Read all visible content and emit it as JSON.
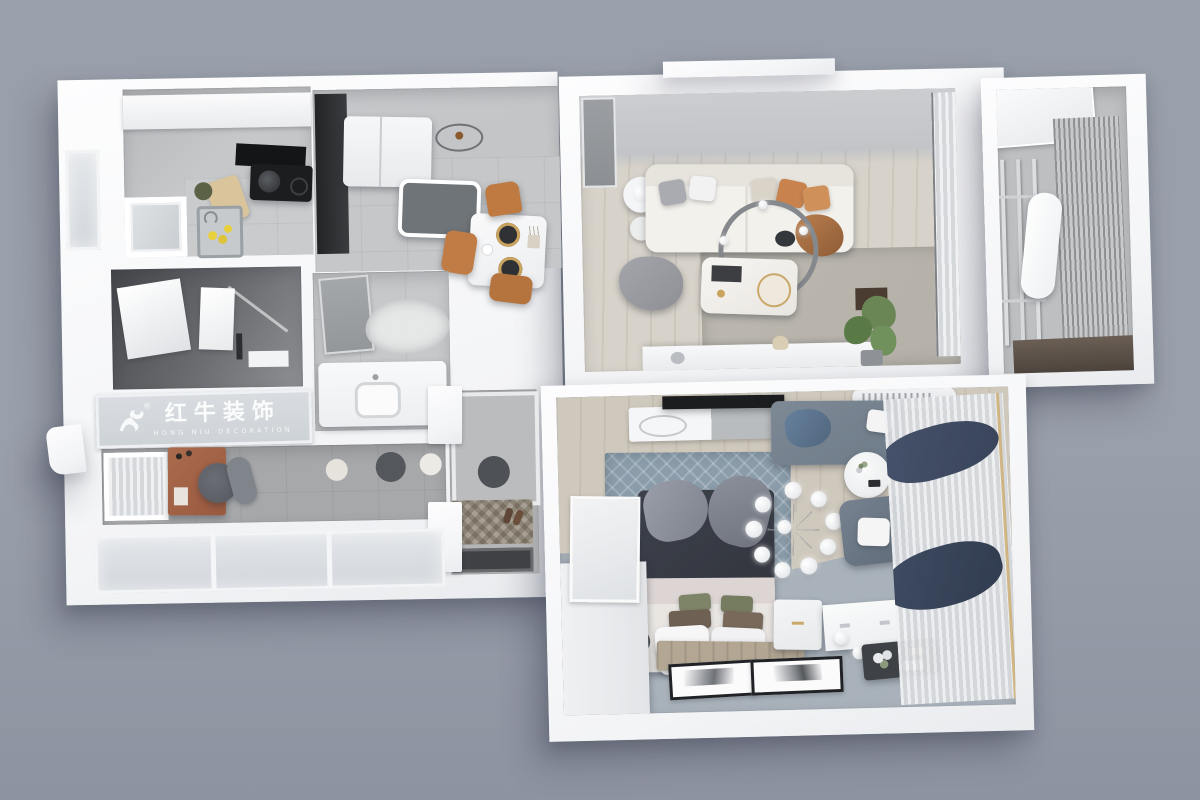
{
  "image": {
    "kind": "3D rendered top-down apartment floor plan (interior design visualization)",
    "background_color": "#9aa0ab"
  },
  "watermark": {
    "logo_icon": "bull-icon",
    "registered_mark": "®",
    "brand_cn": "红牛装饰",
    "brand_en": "HONG NIU DECORATION"
  },
  "palette": {
    "backdrop": "#9aa0ab",
    "backdrop-deep": "#8d93a0",
    "wall": "#f8f9fa",
    "floor-tile": "#c3c5c7",
    "floor-gray": "#a7a8aa",
    "floor-wood": "#d8d3ca",
    "floor-wood2": "#cfc8bc",
    "floor-blue": "#a9b2bb",
    "dark-room": "#55575b",
    "logo-text": "#ffffff",
    "sofa": "#f3f1ec",
    "accent-orange": "#c8824d",
    "rug-living": "#b4b0a8",
    "rug-bedroom": "#8b9dab",
    "duvet": "#33363e",
    "armchair": "#6e7b88",
    "drape-navy": "#39445a",
    "desk-terracotta": "#9a5a40",
    "chair-dark": "#55595f",
    "dining-chair": "#bf7a41",
    "appliance-black": "#1c1d1f",
    "plant-green": "#6a8655",
    "mat-dark": "#3f4144",
    "mat-base": "#8d8577",
    "bench": "#b3a794",
    "gold": "#c9a86a"
  },
  "rooms": [
    {
      "name": "kitchen",
      "items": [
        "upper-cabinets",
        "range-hood",
        "cooktop",
        "pan",
        "cutting-board",
        "sink",
        "lemons",
        "window"
      ]
    },
    {
      "name": "bathroom",
      "items": [
        "mirror",
        "shower-screen",
        "glass-partition",
        "shelf"
      ]
    },
    {
      "name": "dining-area",
      "items": [
        "fridge",
        "tall-cabinet",
        "console-table",
        "ceiling-lamp",
        "dining-table",
        "place-settings",
        "orange-chairs"
      ]
    },
    {
      "name": "wash-area",
      "items": [
        "bathroom-door",
        "cloud-rug",
        "vanity-counter",
        "basin"
      ]
    },
    {
      "name": "study-nook",
      "items": [
        "window-curtain",
        "terracotta-desk",
        "office-chair",
        "round-floor-mats"
      ]
    },
    {
      "name": "entry-hall",
      "items": [
        "shoe-cabinets",
        "round-rug",
        "patterned-mat",
        "shoes",
        "door-mat"
      ]
    },
    {
      "name": "living-room",
      "items": [
        "side-table-lamp",
        "white-sofa",
        "throw-pillows",
        "ring-chandelier",
        "marble-coffee-table",
        "pouf-blanket",
        "area-rug",
        "tv-console",
        "potted-plant",
        "window-curtain"
      ]
    },
    {
      "name": "balcony",
      "items": [
        "glass-door",
        "drying-rack",
        "hanging-garment",
        "roller-blind",
        "planter-ledge"
      ]
    },
    {
      "name": "bedroom",
      "items": [
        "tv",
        "dresser",
        "air-conditioner",
        "patterned-rug",
        "bed",
        "pillows",
        "bench",
        "sphere-chandelier",
        "daybed",
        "round-side-table",
        "armchair",
        "wardrobe",
        "nightstand",
        "headboard-panel",
        "decor-tray",
        "floor-frames",
        "curtains"
      ]
    }
  ]
}
